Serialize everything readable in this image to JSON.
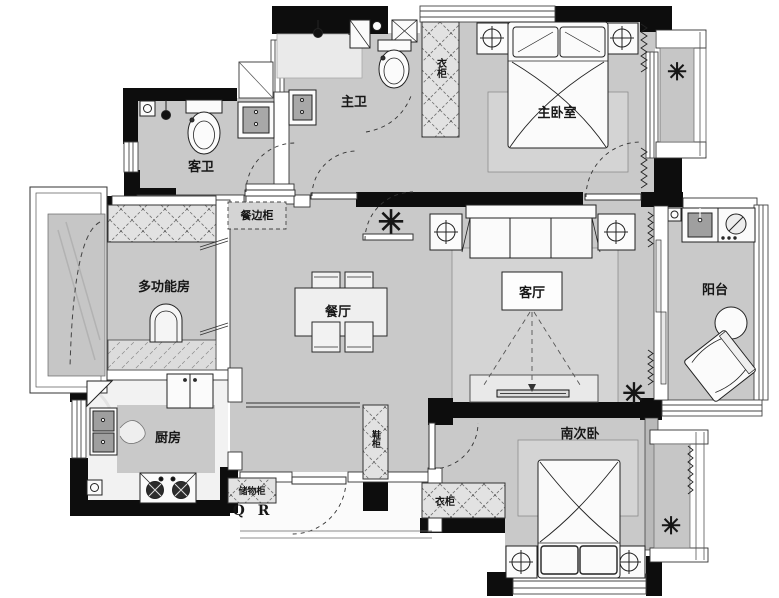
{
  "meta": {
    "document_type": "residential apartment floor plan",
    "language": "zh-CN"
  },
  "colors": {
    "wall": "#0d0d0d",
    "floor": "#c9c9c9",
    "floor_light": "#f2f2f2",
    "bay_glass": "#c6c6c6",
    "rug": "#d4d4d4",
    "cabinet_fill": "#e2e2e2",
    "fixture_dark": "#9f9f9f",
    "outline": "#2b2b2b",
    "label": "#161616"
  },
  "labels": {
    "guest_bath": "客卫",
    "master_bath": "主卫",
    "master_bedroom": "主卧室",
    "master_wardrobe": "衣柜",
    "multi_function_room": "多功能房",
    "sideboard": "餐边柜",
    "dining_room": "餐厅",
    "living_room": "客厅",
    "balcony": "阳台",
    "kitchen": "厨房",
    "storage_cabinet": "储物柜",
    "brand_mark": "Q R",
    "shoe_cabinet": "鞋柜",
    "south_bedroom": "南次卧",
    "south_wardrobe": "衣柜"
  },
  "icons": {
    "plant": "✳"
  }
}
